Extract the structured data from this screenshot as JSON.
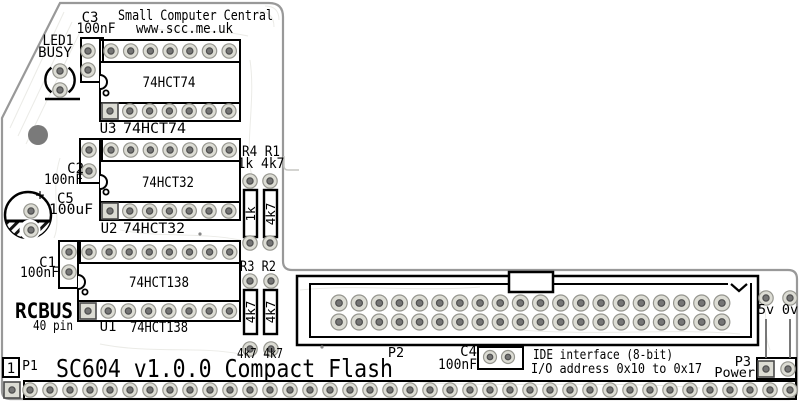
{
  "board": {
    "brand": "Small Computer Central",
    "url": "www.scc.me.uk",
    "title": "SC604 v1.0.0 Compact Flash",
    "bus_logo": "RCBUS",
    "bus_pins": "40 pin"
  },
  "silkscreen": {
    "led1_ref": "LED1",
    "led1_label": "BUSY",
    "c3_ref": "C3",
    "c3_value": "100nF",
    "c2_ref": "C2",
    "c2_value": "100nF",
    "c5_ref": "C5",
    "c5_value": "100uF",
    "c5_polarity": "+",
    "c1_ref": "C1",
    "c1_value": "100nF",
    "c4_ref": "C4",
    "c4_value": "100nF",
    "u3_ref": "U3",
    "u3_part": "74HCT74",
    "u2_ref": "U2",
    "u2_part": "74HCT32",
    "u1_ref": "U1",
    "u1_part": "74HCT138",
    "r4_r1_refs": "R4 R1",
    "r4_r1_values": "1k 4k7",
    "r4_value": "1k",
    "r1_value": "4k7",
    "r3_r2_refs": "R3 R2",
    "r3_value": "4k7",
    "r2_value": "4k7",
    "r3_r2_values": "4k7 4k7",
    "p1_ref": "P1",
    "p1_pin1": "1",
    "p2_ref": "P2",
    "p3_ref": "P3",
    "p3_label": "Power",
    "p3_5v": "5v",
    "p3_0v": "0v",
    "ide_line1": "IDE interface (8-bit)",
    "ide_line2": "I/O address 0x10 to 0x17"
  },
  "colors": {
    "silkscreen": "#000000",
    "board_edge": "#999999",
    "trace": "#ebebe7",
    "pad_ring": "#dcdcd4",
    "pad_ring_border": "#96968f",
    "pad_hole": "#757575",
    "pad_hole_border": "#4f4f4f",
    "mount_hole": "#7a7a7a"
  },
  "pad_groups": [
    {
      "name": "c3-pads",
      "x": 88,
      "y": 51,
      "cols": 1,
      "rows": 2,
      "dy": 19
    },
    {
      "name": "led1-pads",
      "x": 60,
      "y": 71,
      "cols": 1,
      "rows": 2,
      "dy": 19
    },
    {
      "name": "u3-pads-top",
      "x": 111,
      "y": 51,
      "cols": 7,
      "dx": 19.7
    },
    {
      "name": "u3-pads-bottom",
      "x": 110,
      "y": 111,
      "cols": 7,
      "dx": 19.8,
      "square_first": true
    },
    {
      "name": "c2-pads",
      "x": 89,
      "y": 150,
      "cols": 1,
      "rows": 2,
      "dy": 21
    },
    {
      "name": "u2-pads-top",
      "x": 111,
      "y": 150,
      "cols": 7,
      "dx": 19.7
    },
    {
      "name": "u2-pads-bottom",
      "x": 110,
      "y": 211,
      "cols": 7,
      "dx": 19.8,
      "square_first": true
    },
    {
      "name": "c5-pads",
      "x": 31,
      "y": 211,
      "cols": 1,
      "rows": 2,
      "dy": 19
    },
    {
      "name": "c1-pads",
      "x": 69,
      "y": 252,
      "cols": 1,
      "rows": 2,
      "dy": 20
    },
    {
      "name": "u1-pads-top",
      "x": 89,
      "y": 252,
      "cols": 8,
      "dx": 20.1
    },
    {
      "name": "u1-pads-bottom",
      "x": 88,
      "y": 311,
      "cols": 8,
      "dx": 20.2,
      "square_first": true
    },
    {
      "name": "r4-pads",
      "x": 250,
      "y": 181,
      "cols": 1,
      "rows": 2,
      "dy": 62
    },
    {
      "name": "r1-pads",
      "x": 270,
      "y": 181,
      "cols": 1,
      "rows": 2,
      "dy": 62
    },
    {
      "name": "r3-pads",
      "x": 250,
      "y": 281,
      "cols": 1,
      "rows": 2,
      "dy": 68
    },
    {
      "name": "r2-pads",
      "x": 271,
      "y": 281,
      "cols": 1,
      "rows": 2,
      "dy": 68
    },
    {
      "name": "p2-pads",
      "x": 339,
      "y": 303,
      "cols": 20,
      "rows": 2,
      "dx": 20.15,
      "dy": 19,
      "r": 8,
      "hole": 3.3
    },
    {
      "name": "c4-pads",
      "x": 490,
      "y": 357,
      "cols": 2,
      "dx": 18,
      "r": 6.5,
      "hole": 2.8
    },
    {
      "name": "p1-pin1-pad",
      "x": 12,
      "y": 390,
      "cols": 1,
      "square_first": true
    },
    {
      "name": "p1-pads",
      "x": 30,
      "y": 390,
      "cols": 39,
      "dx": 20
    },
    {
      "name": "power-5v-pad",
      "x": 766,
      "y": 298,
      "cols": 1
    },
    {
      "name": "power-0v-pad",
      "x": 790,
      "y": 298,
      "cols": 1
    },
    {
      "name": "p3-square-pad",
      "x": 766,
      "y": 369,
      "cols": 1,
      "square_first": true
    },
    {
      "name": "p3-round-pad",
      "x": 788,
      "y": 369,
      "cols": 1
    }
  ]
}
